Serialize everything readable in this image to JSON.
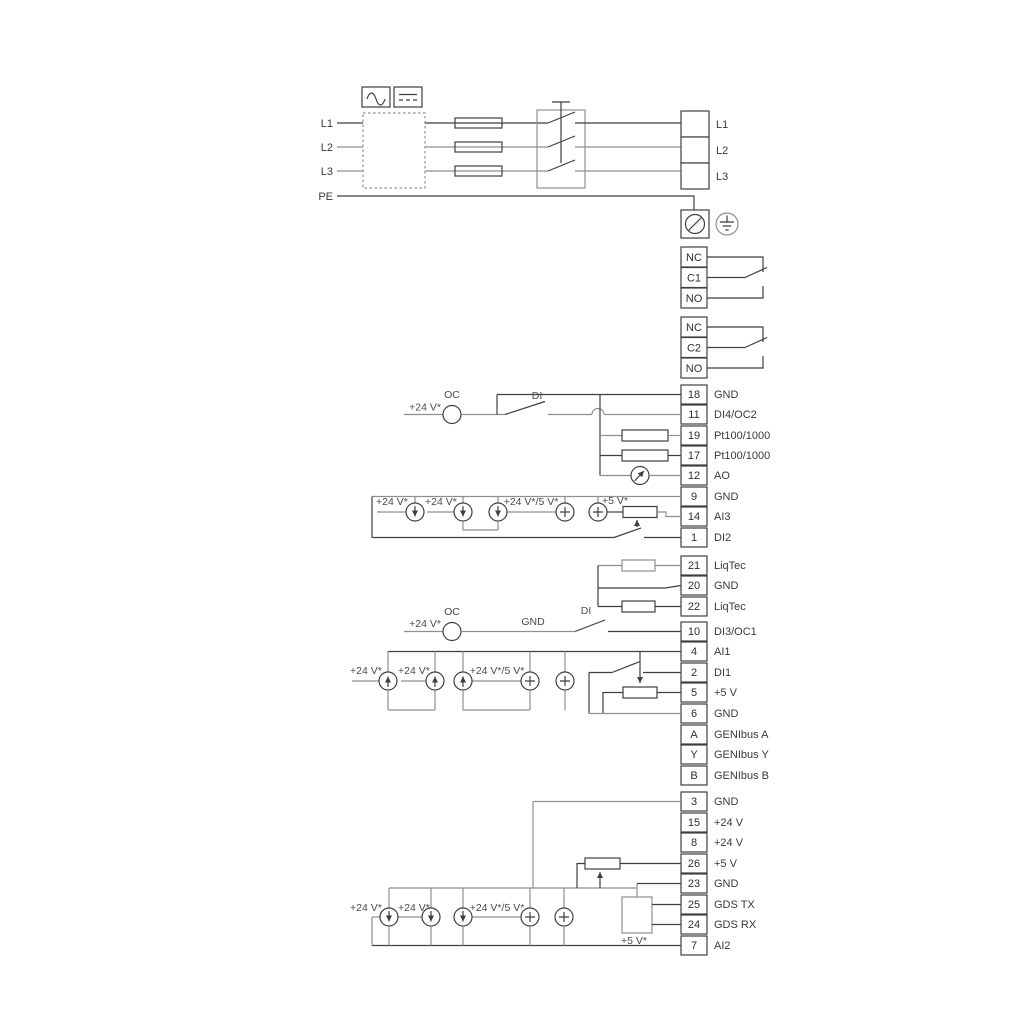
{
  "colors": {
    "background": "#ffffff",
    "wire_dark": "#3f3f3f",
    "wire_light": "#8f8f8f",
    "text": "#3a3a3a"
  },
  "power": {
    "inputs": {
      "l1": "L1",
      "l2": "L2",
      "l3": "L3",
      "pe": "PE"
    },
    "outputs": {
      "l1": "L1",
      "l2": "L2",
      "l3": "L3"
    }
  },
  "relay1": {
    "nc": "NC",
    "c": "C1",
    "no": "NO"
  },
  "relay2": {
    "nc": "NC",
    "c": "C2",
    "no": "NO"
  },
  "strip1": [
    {
      "num": "18",
      "label": "GND"
    },
    {
      "num": "11",
      "label": "DI4/OC2"
    },
    {
      "num": "19",
      "label": "Pt100/1000"
    },
    {
      "num": "17",
      "label": "Pt100/1000"
    },
    {
      "num": "12",
      "label": "AO"
    },
    {
      "num": "9",
      "label": "GND"
    },
    {
      "num": "14",
      "label": "AI3"
    },
    {
      "num": "1",
      "label": "DI2"
    }
  ],
  "strip2": [
    {
      "num": "21",
      "label": "LiqTec"
    },
    {
      "num": "20",
      "label": "GND"
    },
    {
      "num": "22",
      "label": "LiqTec"
    }
  ],
  "strip3": [
    {
      "num": "10",
      "label": "DI3/OC1"
    },
    {
      "num": "4",
      "label": "AI1"
    },
    {
      "num": "2",
      "label": "DI1"
    },
    {
      "num": "5",
      "label": "+5 V"
    },
    {
      "num": "6",
      "label": "GND"
    },
    {
      "num": "A",
      "label": "GENIbus A"
    },
    {
      "num": "Y",
      "label": "GENIbus Y"
    },
    {
      "num": "B",
      "label": "GENIbus B"
    }
  ],
  "strip4": [
    {
      "num": "3",
      "label": "GND"
    },
    {
      "num": "15",
      "label": "+24 V"
    },
    {
      "num": "8",
      "label": "+24 V"
    },
    {
      "num": "26",
      "label": "+5 V"
    },
    {
      "num": "23",
      "label": "GND"
    },
    {
      "num": "25",
      "label": "GDS TX"
    },
    {
      "num": "24",
      "label": "GDS RX"
    },
    {
      "num": "7",
      "label": "AI2"
    }
  ],
  "sec_di4": {
    "supply": "+24 V*",
    "oc": "OC",
    "di": "DI"
  },
  "sec_ai3": {
    "s1": "+24 V*",
    "s2": "+24 V*",
    "s3": "+24 V*/5 V*",
    "s4": "+5 V*"
  },
  "sec_di3": {
    "supply": "+24 V*",
    "oc": "OC",
    "gnd": "GND",
    "di": "DI"
  },
  "sec_ai1": {
    "s1": "+24 V*",
    "s2": "+24 V*",
    "s3": "+24 V*/5 V*"
  },
  "sec_ai2": {
    "s1": "+24 V*",
    "s2": "+24 V*",
    "s3": "+24 V*/5 V*",
    "s4": "+5 V*"
  }
}
